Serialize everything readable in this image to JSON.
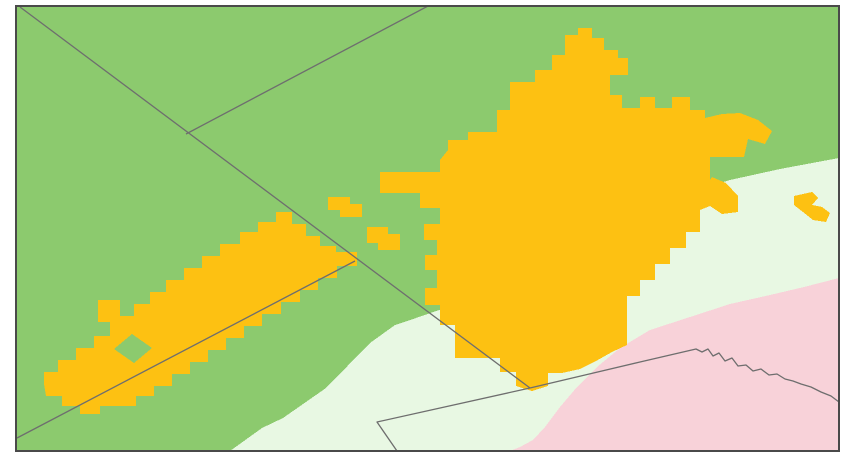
{
  "map": {
    "canvas": {
      "width": 850,
      "height": 464,
      "background": "#ffffff"
    },
    "frame": {
      "x": 16,
      "y": 6,
      "width": 823,
      "height": 445,
      "stroke": "#4a4a4a",
      "stroke_width": 2
    },
    "colors": {
      "base_green": "#8cca6e",
      "mint": "#e8f8e3",
      "pink": "#f8d2d9",
      "urban_orange": "#fdc112",
      "boundary_gray": "#6e6e6e",
      "frame_gray": "#4a4a4a"
    },
    "line_style": {
      "stroke": "#6e6e6e",
      "width": 1.3
    },
    "regions": [
      {
        "name": "region-base-green",
        "fill": "#8cca6e",
        "interactable": true,
        "points": "16,6 839,6 839,451 16,451"
      },
      {
        "name": "region-mint",
        "fill": "#e8f8e3",
        "interactable": true,
        "points": "230,451 262,428 283,418 326,388 370,343 395,325 416,318 445,308 475,302 510,298 545,288 570,272 600,245 625,222 648,206 680,195 730,180 780,169 839,158 839,451"
      },
      {
        "name": "region-pink",
        "fill": "#f8d2d9",
        "interactable": true,
        "points": "510,451 520,447 533,440 545,427 560,407 577,387 597,367 620,348 650,330 690,317 730,304 770,295 804,287 839,278 839,451"
      },
      {
        "name": "urban-strip-southwest",
        "fill": "#fdc112",
        "interactable": true,
        "points": "357,252 357,266 337,266 337,278 318,278 318,290 300,290 300,302 281,302 281,314 262,314 262,326 244,326 244,338 226,338 226,350 208,350 208,362 190,362 190,374 172,374 172,386 154,386 154,396 136,396 136,406 100,406 100,414 80,414 80,406 62,406 62,396 46,396 44,384 44,372 58,372 58,360 76,360 76,348 94,348 94,336 110,336 110,322 98,322 98,300 120,300 120,316 134,316 134,304 150,304 150,292 166,292 166,280 184,280 184,268 202,268 202,256 220,256 220,244 240,244 240,232 258,232 258,222 276,222 276,212 292,212 292,224 306,224 306,236 320,236 320,246 336,246 336,252"
      },
      {
        "name": "urban-strip-hole",
        "fill": "#8cca6e",
        "interactable": false,
        "points": "132,334 152,348 134,363 114,349"
      },
      {
        "name": "urban-island-small-a",
        "fill": "#fdc112",
        "interactable": true,
        "points": "328,197 350,197 350,204 362,204 362,217 340,217 340,210 328,210"
      },
      {
        "name": "urban-island-small-b",
        "fill": "#fdc112",
        "interactable": true,
        "points": "367,227 388,227 388,234 400,234 400,250 378,250 378,243 367,243"
      },
      {
        "name": "urban-island-small-c",
        "fill": "#fdc112",
        "interactable": true,
        "points": "128,380 148,380 148,392 128,392"
      },
      {
        "name": "urban-main-city",
        "fill": "#fdc112",
        "interactable": true,
        "points": "448,150 448,140 468,140 468,132 497,132 497,110 510,110 510,82 535,82 535,70 552,70 552,55 565,55 565,35 578,35 578,28 592,28 592,38 604,38 604,50 618,50 618,58 628,58 628,75 610,75 610,95 622,95 622,108 640,108 640,97 655,97 655,108 672,108 672,97 690,97 690,110 705,110 705,118 722,114 740,113 758,120 772,131 765,144 748,139 744,157 710,157 710,180 712,177 726,183 738,196 738,212 722,214 710,206 700,210 700,232 686,232 686,248 670,248 670,264 655,264 655,280 640,280 640,296 627,296 627,345 612,352 596,361 580,369 562,373 548,373 548,386 532,391 516,386 516,372 500,372 500,358 455,358 455,325 440,325 440,305 425,305 425,288 437,288 437,270 425,270 425,255 437,255 437,240 424,240 424,224 440,224 440,208 420,208 420,193 380,193 380,172 440,172 440,160"
      },
      {
        "name": "urban-island-east",
        "fill": "#fdc112",
        "interactable": true,
        "points": "794,196 812,192 818,198 812,205 822,207 830,213 826,222 813,220 803,212 794,205"
      }
    ],
    "boundary_lines": [
      {
        "name": "boundary-line-northwest",
        "points": "20,7 530,388"
      },
      {
        "name": "boundary-line-north-branch",
        "points": "186,134 428,6"
      },
      {
        "name": "boundary-line-southwest",
        "points": "17,438 355,261"
      },
      {
        "name": "boundary-line-east-wiggly",
        "points": "530,388 585,375 640,362 696,349 702,352 708,349 713,356 719,353 725,361 732,358 738,366 746,365 753,371 761,369 769,375 777,374 785,379 793,381 801,384 811,387 821,392 831,396 839,402"
      },
      {
        "name": "boundary-line-south-notch",
        "points": "530,388 377,422 397,451"
      }
    ]
  }
}
